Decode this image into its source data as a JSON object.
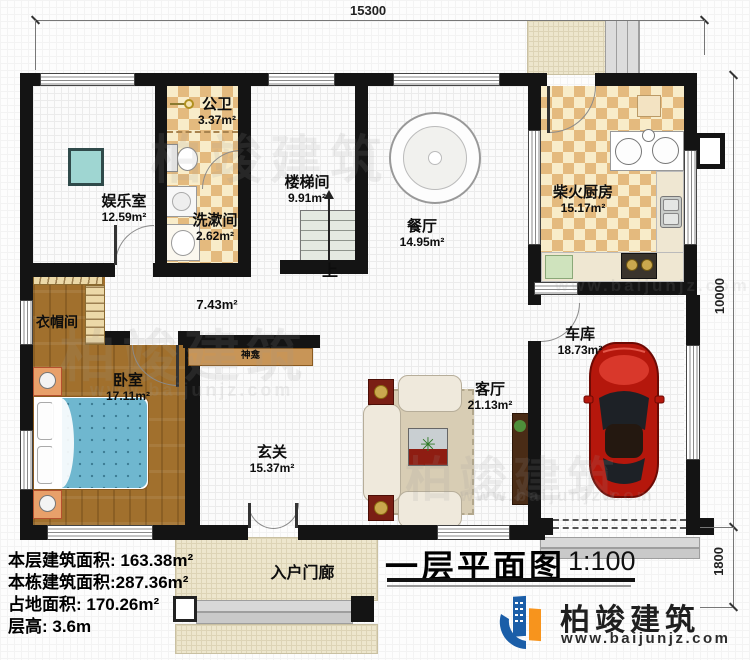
{
  "plan": {
    "title": "一层平面图",
    "scale": "1:100",
    "up_label": "上"
  },
  "dimensions": {
    "top_width": "15300",
    "right_height": "10000",
    "porch_depth": "1800"
  },
  "rooms": {
    "entertainment": {
      "name": "娱乐室",
      "area": "12.59m²"
    },
    "public_bath": {
      "name": "公卫",
      "area": "3.37m²"
    },
    "washroom": {
      "name": "洗漱间",
      "area": "2.62m²"
    },
    "stairwell": {
      "name": "楼梯间",
      "area": "9.91m²"
    },
    "dining": {
      "name": "餐厅",
      "area": "14.95m²"
    },
    "kitchen": {
      "name": "柴火厨房",
      "area": "15.17m²"
    },
    "garage": {
      "name": "车库",
      "area": "18.73m²"
    },
    "cloakroom": {
      "name": "衣帽间"
    },
    "bedroom": {
      "name": "卧室",
      "area": "17.11m²"
    },
    "corridor": {
      "area": "7.43m²"
    },
    "shrine": {
      "name": "神龛"
    },
    "foyer": {
      "name": "玄关",
      "area": "15.37m²"
    },
    "living": {
      "name": "客厅",
      "area": "21.13m²"
    },
    "porch": {
      "name": "入户门廊"
    }
  },
  "info": {
    "lines": [
      "本层建筑面积: 163.38m²",
      "本栋建筑面积:287.36m²",
      "占地面积: 170.26m²",
      "层高: 3.6m"
    ]
  },
  "brand": {
    "name": "柏竣建筑",
    "url": "www.baijunjz.com",
    "blue": "#1b5ea8",
    "orange": "#f7941d"
  }
}
